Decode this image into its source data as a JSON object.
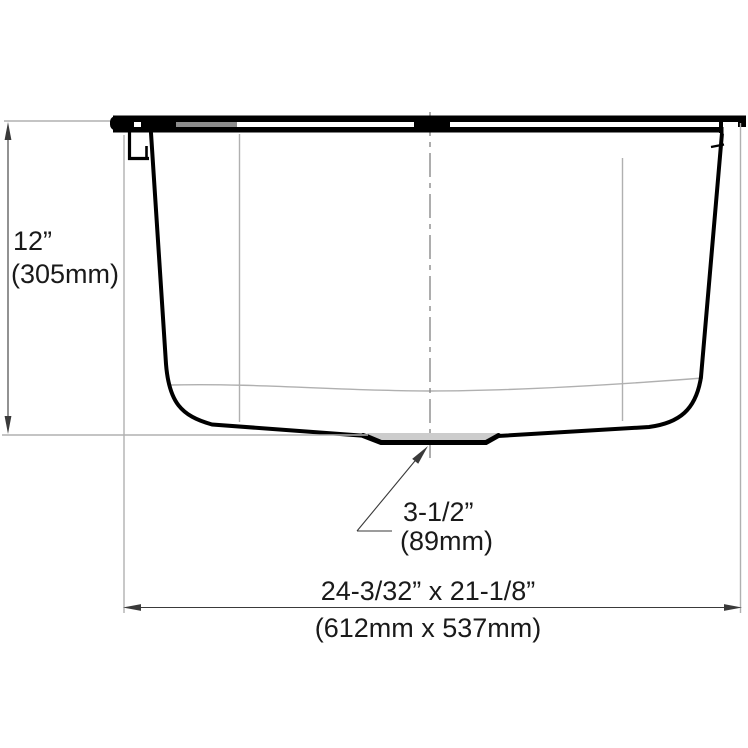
{
  "dimensions": {
    "height": {
      "imperial": "12”",
      "metric": "(305mm)"
    },
    "drain": {
      "imperial": "3-1/2”",
      "metric": "(89mm)"
    },
    "overall": {
      "imperial": "24-3/32” x 21-1/8”",
      "metric": "(612mm x 537mm)"
    }
  },
  "colors": {
    "outline": "#000000",
    "projection": "#b0b0b0",
    "centerline": "#8a8a8a",
    "dimension": "#3a3a3a",
    "drain_fill": "#cccccc",
    "bg": "#ffffff",
    "text": "#1a1a1a"
  }
}
